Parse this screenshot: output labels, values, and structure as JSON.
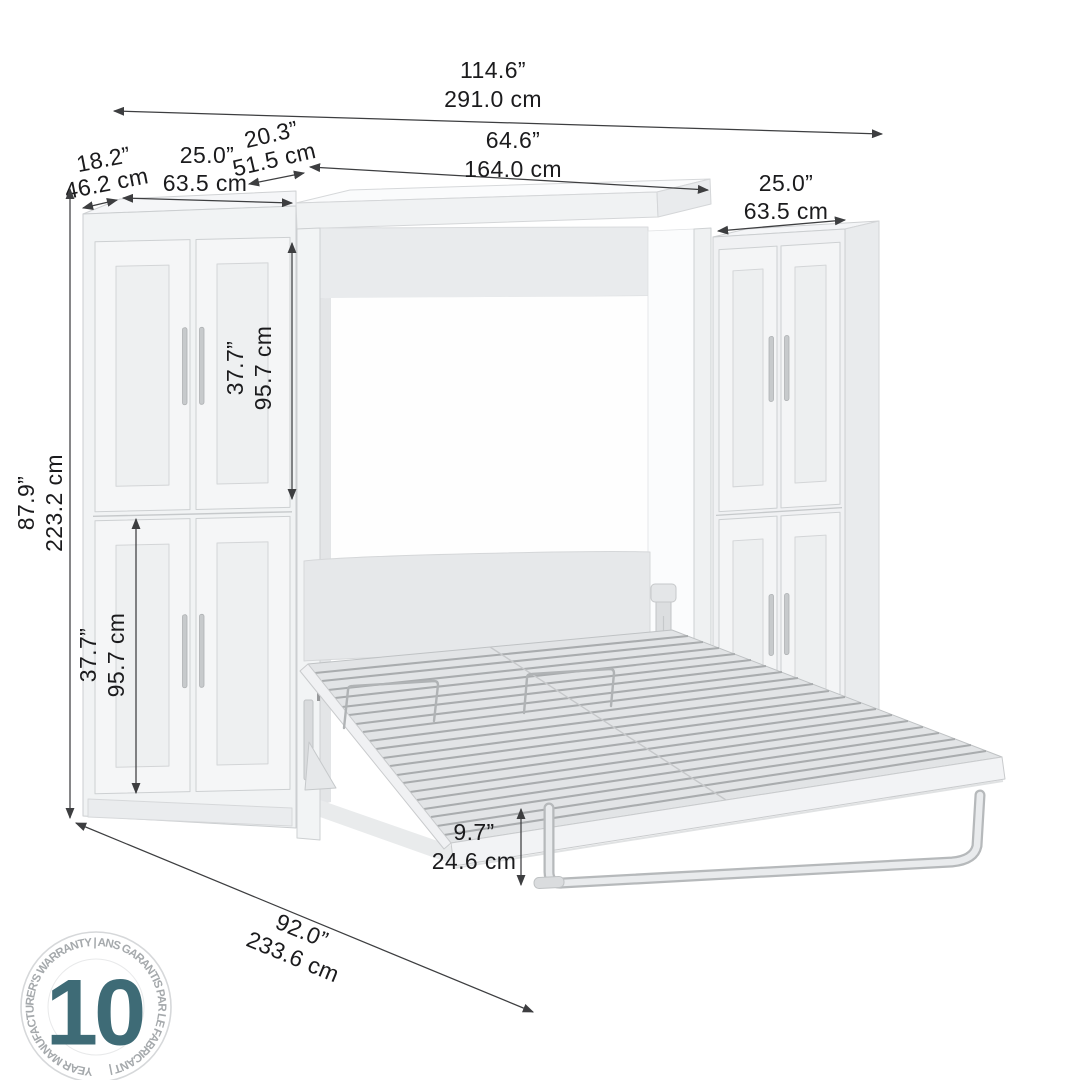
{
  "dims": {
    "total_width": {
      "in": "114.6”",
      "cm": "291.0 cm"
    },
    "bed_width": {
      "in": "64.6”",
      "cm": "164.0 cm"
    },
    "bed_top_depth": {
      "in": "20.3”",
      "cm": "51.5 cm"
    },
    "left_depth": {
      "in": "18.2”",
      "cm": "46.2 cm"
    },
    "left_width": {
      "in": "25.0”",
      "cm": "63.5 cm"
    },
    "right_width": {
      "in": "25.0”",
      "cm": "63.5 cm"
    },
    "height": {
      "in": "87.9”",
      "cm": "223.2 cm"
    },
    "upper_section": {
      "in": "37.7”",
      "cm": "95.7 cm"
    },
    "lower_section": {
      "in": "37.7”",
      "cm": "95.7 cm"
    },
    "floor_clearance": {
      "in": "9.7”",
      "cm": "24.6 cm"
    },
    "open_depth": {
      "in": "92.0”",
      "cm": "233.6 cm"
    }
  },
  "badge": {
    "value": "10",
    "caption": "YEAR MANUFACTURER'S WARRANTY  |  ANS GARANTIS PAR LE FABRICANT  |",
    "accent_color": "#3e6b76",
    "caption_color": "#a5a9ac"
  },
  "colors": {
    "dimension_line": "#3d3e40",
    "dimension_text": "#1b1b1d",
    "furniture_light": "#f3f4f6",
    "furniture_shadow": "#e8eaec",
    "background": "#ffffff"
  }
}
